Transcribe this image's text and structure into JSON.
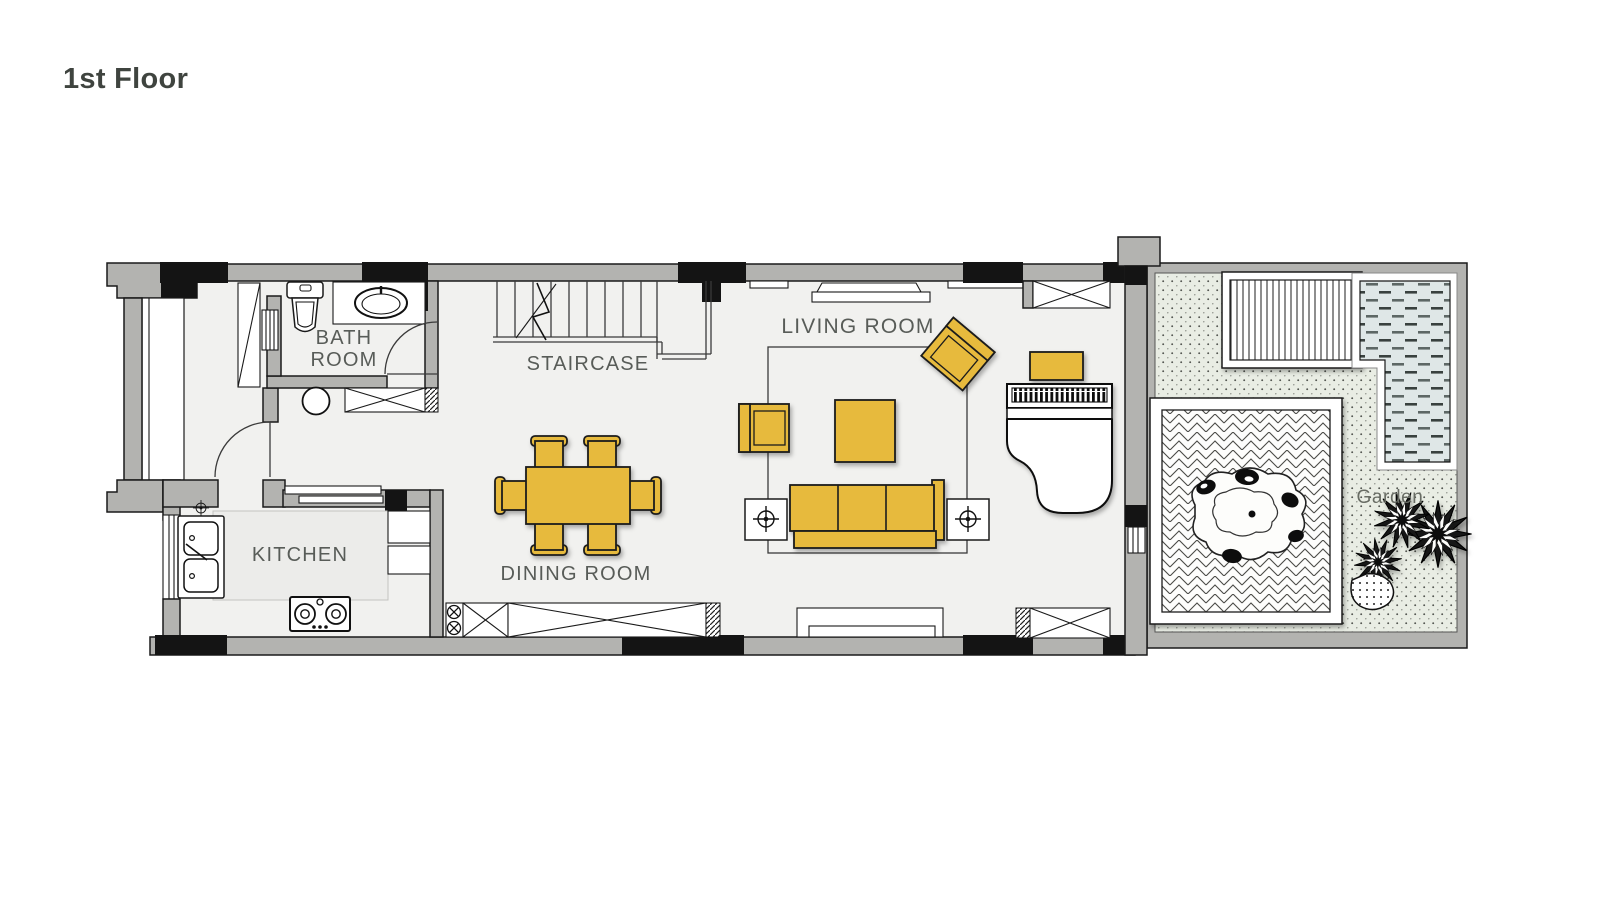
{
  "title": "1st Floor",
  "labels": {
    "bathroom_line1": "BATH",
    "bathroom_line2": "ROOM",
    "staircase": "STAIRCASE",
    "kitchen": "KITCHEN",
    "dining_room": "DINING ROOM",
    "living_room": "LIVING ROOM",
    "garden": "Garden"
  },
  "colors": {
    "canvas-bg": "#ffffff",
    "floor": "#f1f1ef",
    "wall": "#b3b3b0",
    "wall-dark": "#141414",
    "furniture-yellow": "#e7ba3e",
    "garden-bg": "#e9ede4",
    "pool-water": "#dfe7e7",
    "label-text": "#585c58",
    "title-text": "#3f443f",
    "line": "#1a1a1a"
  }
}
